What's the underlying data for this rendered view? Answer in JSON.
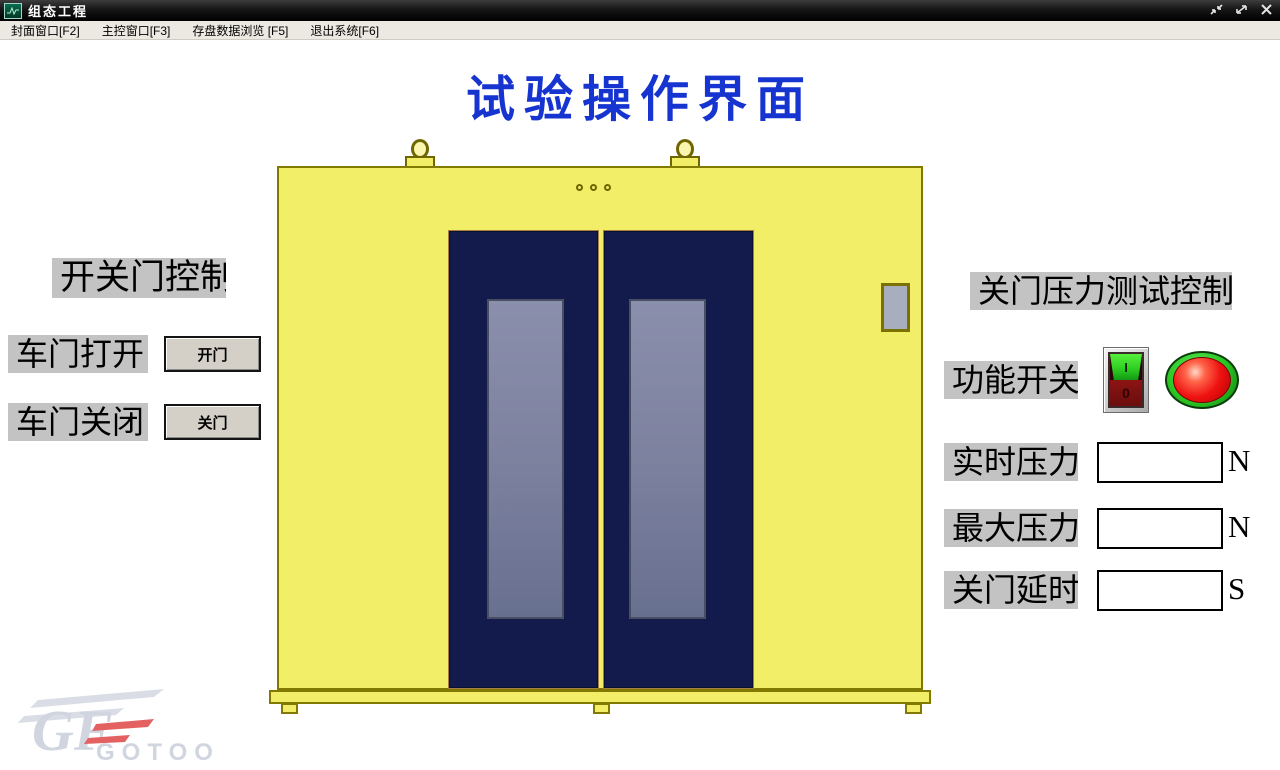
{
  "window": {
    "title": "组态工程",
    "app_icon": "waveform-screen-icon",
    "buttons": [
      {
        "name": "restore",
        "icon": "restore-icon"
      },
      {
        "name": "maximize",
        "icon": "maximize-icon"
      },
      {
        "name": "close",
        "icon": "close-icon"
      }
    ]
  },
  "menu": {
    "items": [
      {
        "label": "封面窗口[F2]"
      },
      {
        "label": "主控窗口[F3]"
      },
      {
        "label": "存盘数据浏览 [F5]"
      },
      {
        "label": "退出系统[F6]"
      }
    ]
  },
  "page": {
    "title": "试验操作界面"
  },
  "door_control": {
    "group_label": "开关门控制",
    "open_label": "车门打开",
    "open_button": "开门",
    "close_label": "车门关闭",
    "close_button": "关门"
  },
  "pressure_control": {
    "group_label": "关门压力测试控制",
    "function_label": "功能开关",
    "switch": {
      "on_mark": "I",
      "off_mark": "0"
    },
    "indicator": {
      "lamp_color": "#ee1212",
      "bezel_color": "#2bc724"
    },
    "realtime": {
      "label": "实时压力",
      "value": "",
      "unit": "N"
    },
    "max": {
      "label": "最大压力",
      "value": "",
      "unit": "N"
    },
    "delay": {
      "label": "关门延时",
      "value": "",
      "unit": "S"
    }
  },
  "diagram": {
    "name": "door-test-chamber-drawing",
    "body_color": "#f3ee67",
    "outline_color": "#827a00",
    "door_color": "#131b4d",
    "glass_color": "#7e83a0"
  },
  "watermark": {
    "monogram": "GF",
    "text": "GOTOO"
  },
  "colors": {
    "title_blue": "#1634d0",
    "label_bg": "#c3c3c3",
    "titlebar": "#161616",
    "menubar": "#ece9e2"
  }
}
